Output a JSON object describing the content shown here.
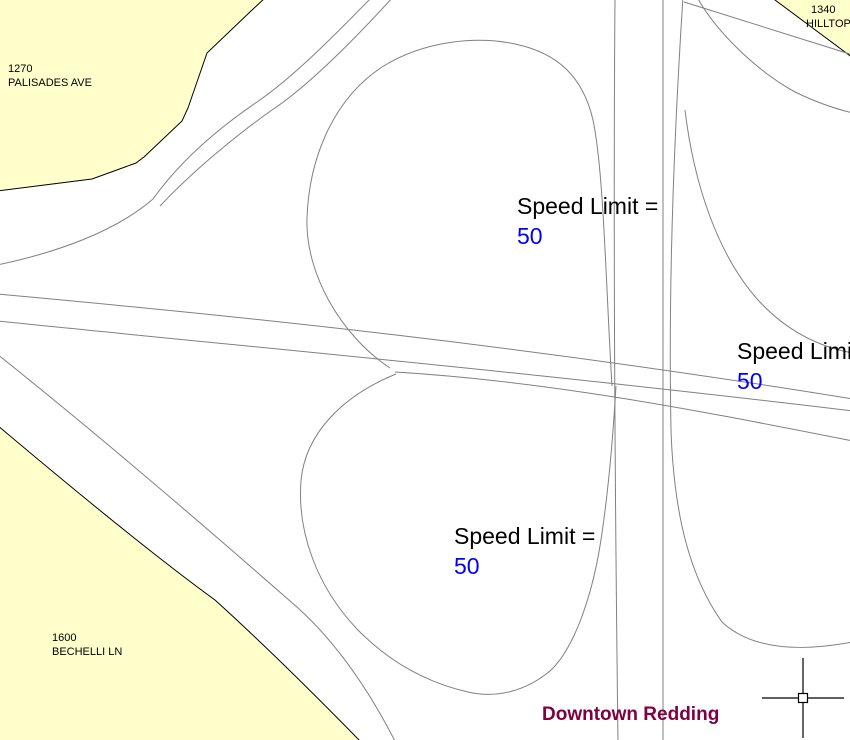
{
  "map": {
    "region_label": "Downtown Redding",
    "colors": {
      "parcel_fill": "#FFFFCC",
      "parcel_border": "#000000",
      "road_line": "#808080",
      "speed_value_text": "#0000FF",
      "speed_label_text": "#000000",
      "region_label_text": "#800040"
    },
    "parcels": [
      {
        "id": "palisades",
        "number": "1270",
        "street": "PALISADES AVE"
      },
      {
        "id": "hilltop",
        "number": "1340",
        "street": "HILLTOP"
      },
      {
        "id": "bechelli",
        "number": "1600",
        "street": "BECHELLI LN"
      }
    ],
    "speed_labels": [
      {
        "text": "Speed Limit =",
        "value": "50"
      },
      {
        "text": "Speed Limit =",
        "value": "50"
      },
      {
        "text": "Speed Limit =",
        "value": "50"
      }
    ],
    "cursor": {
      "type": "crosshair"
    }
  }
}
